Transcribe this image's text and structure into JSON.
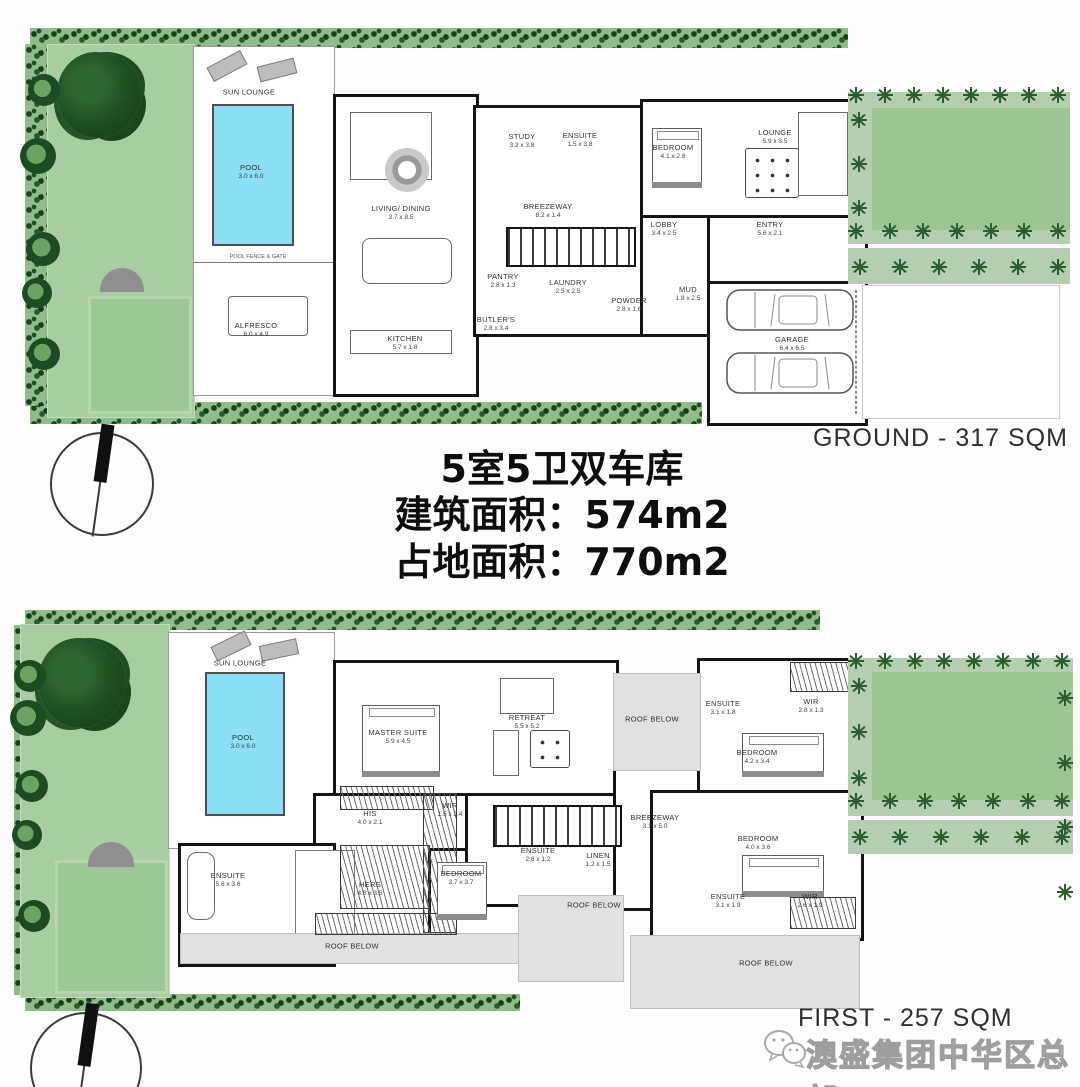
{
  "title_block": {
    "line1": "5室5卫双车库",
    "line2": "建筑面积：574m2",
    "line3": "占地面积：770m2"
  },
  "ground_plan": {
    "caption": "GROUND -  317 SQM",
    "small_texts": {
      "pool_fence": "POOL FENCE & GATE"
    },
    "rooms": [
      {
        "name": "SUN LOUNGE",
        "dims": ""
      },
      {
        "name": "POOL",
        "dims": "3.0 x 6.0"
      },
      {
        "name": "ALFRESCO",
        "dims": "6.0 x 4.9"
      },
      {
        "name": "LIVING/ DINING",
        "dims": "3.7 x 8.5"
      },
      {
        "name": "KITCHEN",
        "dims": "5.7 x 1.8"
      },
      {
        "name": "PANTRY",
        "dims": "2.8 x 1.3"
      },
      {
        "name": "BUTLER'S",
        "dims": "2.8 x 3.4"
      },
      {
        "name": "STUDY",
        "dims": "3.2 x 3.8"
      },
      {
        "name": "ENSUITE",
        "dims": "1.5 x 3.8"
      },
      {
        "name": "BEDROOM",
        "dims": "4.1 x 2.8"
      },
      {
        "name": "BREEZEWAY",
        "dims": "8.2 x 1.4"
      },
      {
        "name": "LOBBY",
        "dims": "3.4 x 2.5"
      },
      {
        "name": "LAUNDRY",
        "dims": "2.5 x 2.5"
      },
      {
        "name": "POWDER",
        "dims": "2.8 x 1.6"
      },
      {
        "name": "MUD",
        "dims": "1.8 x 2.5"
      },
      {
        "name": "ENTRY",
        "dims": "5.6 x 2.1"
      },
      {
        "name": "LOUNGE",
        "dims": "5.9 x 3.5"
      },
      {
        "name": "GARAGE",
        "dims": "6.4 x 6.5"
      }
    ]
  },
  "first_plan": {
    "caption": "FIRST -  257 SQM",
    "rooms": [
      {
        "name": "SUN LOUNGE",
        "dims": ""
      },
      {
        "name": "POOL",
        "dims": "3.0 x 6.0"
      },
      {
        "name": "MASTER SUITE",
        "dims": "5.9 x 4.5"
      },
      {
        "name": "RETREAT",
        "dims": "5.5 x 5.2"
      },
      {
        "name": "ROOF BELOW",
        "dims": ""
      },
      {
        "name": "ENSUITE",
        "dims": "3.1 x 1.8"
      },
      {
        "name": "WIR",
        "dims": "2.8 x 1.3"
      },
      {
        "name": "BEDROOM",
        "dims": "4.2 x 3.4"
      },
      {
        "name": "HIS",
        "dims": "4.0 x 2.1"
      },
      {
        "name": "WIR",
        "dims": "1.5 x 2.4"
      },
      {
        "name": "HERS",
        "dims": "4.8 x 3.5"
      },
      {
        "name": "ENSUITE",
        "dims": "5.6 x 3.6"
      },
      {
        "name": "BEDROOM",
        "dims": "3.7 x 3.7"
      },
      {
        "name": "BREEZEWAY",
        "dims": "3.1 x 5.0"
      },
      {
        "name": "ENSUITE",
        "dims": "2.8 x 1.2"
      },
      {
        "name": "LINEN",
        "dims": "1.2 x 1.5"
      },
      {
        "name": "BEDROOM",
        "dims": "4.0 x 3.6"
      },
      {
        "name": "ENSUITE",
        "dims": "3.1 x 1.9"
      },
      {
        "name": "WIR",
        "dims": "2.6 x 1.9"
      },
      {
        "name": "ROOF BELOW",
        "dims": ""
      },
      {
        "name": "ROOF BELOW",
        "dims": ""
      },
      {
        "name": "ROOF BELOW",
        "dims": ""
      }
    ]
  },
  "watermark": {
    "brand": "澳盛集团中华区总部"
  },
  "colors": {
    "garden_green": "#a9cda2",
    "hedge_green": "#2b5d2f",
    "pool_blue": "#8ce0f5",
    "roof_gray": "#e1e1e1",
    "wall_black": "#141414"
  }
}
